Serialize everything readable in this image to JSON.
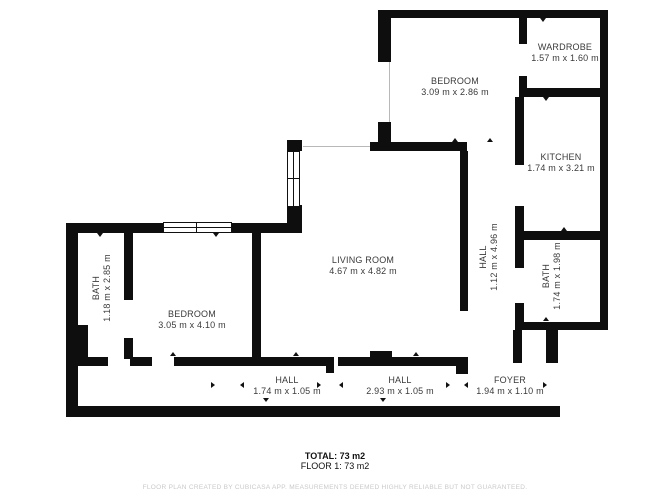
{
  "plan": {
    "rooms": [
      {
        "id": "wardrobe",
        "name": "WARDROBE",
        "dims": "1.57 m x 1.60 m"
      },
      {
        "id": "bedroom-top",
        "name": "BEDROOM",
        "dims": "3.09 m x 2.86 m"
      },
      {
        "id": "kitchen",
        "name": "KITCHEN",
        "dims": "1.74 m x 3.21 m"
      },
      {
        "id": "living-room",
        "name": "LIVING ROOM",
        "dims": "4.67 m x 4.82 m"
      },
      {
        "id": "hall-vertical",
        "name": "HALL",
        "dims": "1.12 m x 4.96 m"
      },
      {
        "id": "bath-right",
        "name": "BATH",
        "dims": "1.74 m x 1.98 m"
      },
      {
        "id": "bath-left",
        "name": "BATH",
        "dims": "1.18 m x 2.85 m"
      },
      {
        "id": "bedroom-left",
        "name": "BEDROOM",
        "dims": "3.05 m x 4.10 m"
      },
      {
        "id": "hall-1",
        "name": "HALL",
        "dims": "1.74 m x 1.05 m"
      },
      {
        "id": "hall-2",
        "name": "HALL",
        "dims": "2.93 m x 1.05 m"
      },
      {
        "id": "foyer",
        "name": "FOYER",
        "dims": "1.94 m x 1.10 m"
      }
    ],
    "summary": {
      "total": "TOTAL: 73 m2",
      "floor": "FLOOR 1: 73 m2"
    },
    "watermark": "FLOOR PLAN CREATED BY CUBICASA APP. MEASUREMENTS DEEMED HIGHLY RELIABLE BUT NOT GUARANTEED.",
    "colors": {
      "wall": "#0e0e0e",
      "label": "#3a3a3a",
      "watermark": "#c9c9c9"
    }
  }
}
